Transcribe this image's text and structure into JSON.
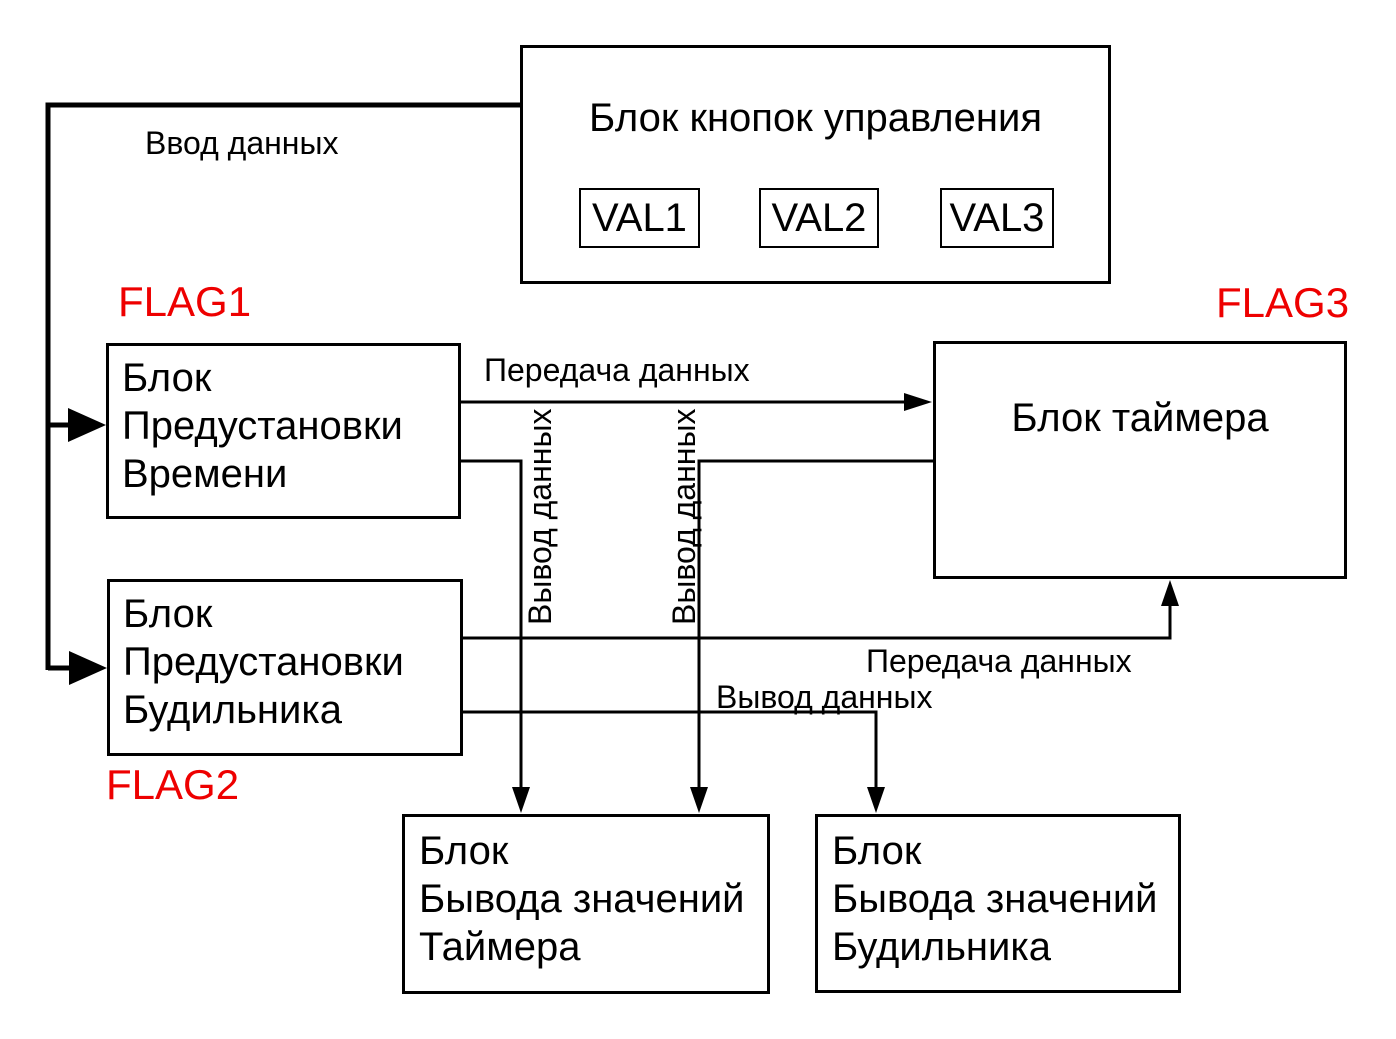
{
  "colors": {
    "flag_label": "#ee0000",
    "line": "#000000",
    "text": "#000000",
    "background": "#ffffff"
  },
  "nodes": {
    "control_buttons": {
      "title": "Блок кнопок управления",
      "buttons": [
        "VAL1",
        "VAL2",
        "VAL3"
      ]
    },
    "time_preset": {
      "lines": [
        "Блок",
        "Предустановки",
        "Времени"
      ]
    },
    "alarm_preset": {
      "lines": [
        "Блок",
        "Предустановки",
        "Будильника"
      ]
    },
    "timer": {
      "title": "Блок таймера"
    },
    "timer_output": {
      "lines": [
        "Блок",
        "Бывода значений",
        "Таймера"
      ]
    },
    "alarm_output": {
      "lines": [
        "Блок",
        "Бывода значений",
        "Будильника"
      ]
    }
  },
  "flags": {
    "flag1": "FLAG1",
    "flag2": "FLAG2",
    "flag3": "FLAG3"
  },
  "edge_labels": {
    "input_data": "Ввод данных",
    "transfer_data_top": "Передача данных",
    "output_data_vertical_left": "Вывод данных",
    "output_data_vertical_right": "Вывод данных",
    "transfer_data_bottom": "Передача данных",
    "output_data_bottom": "Вывод данных"
  }
}
